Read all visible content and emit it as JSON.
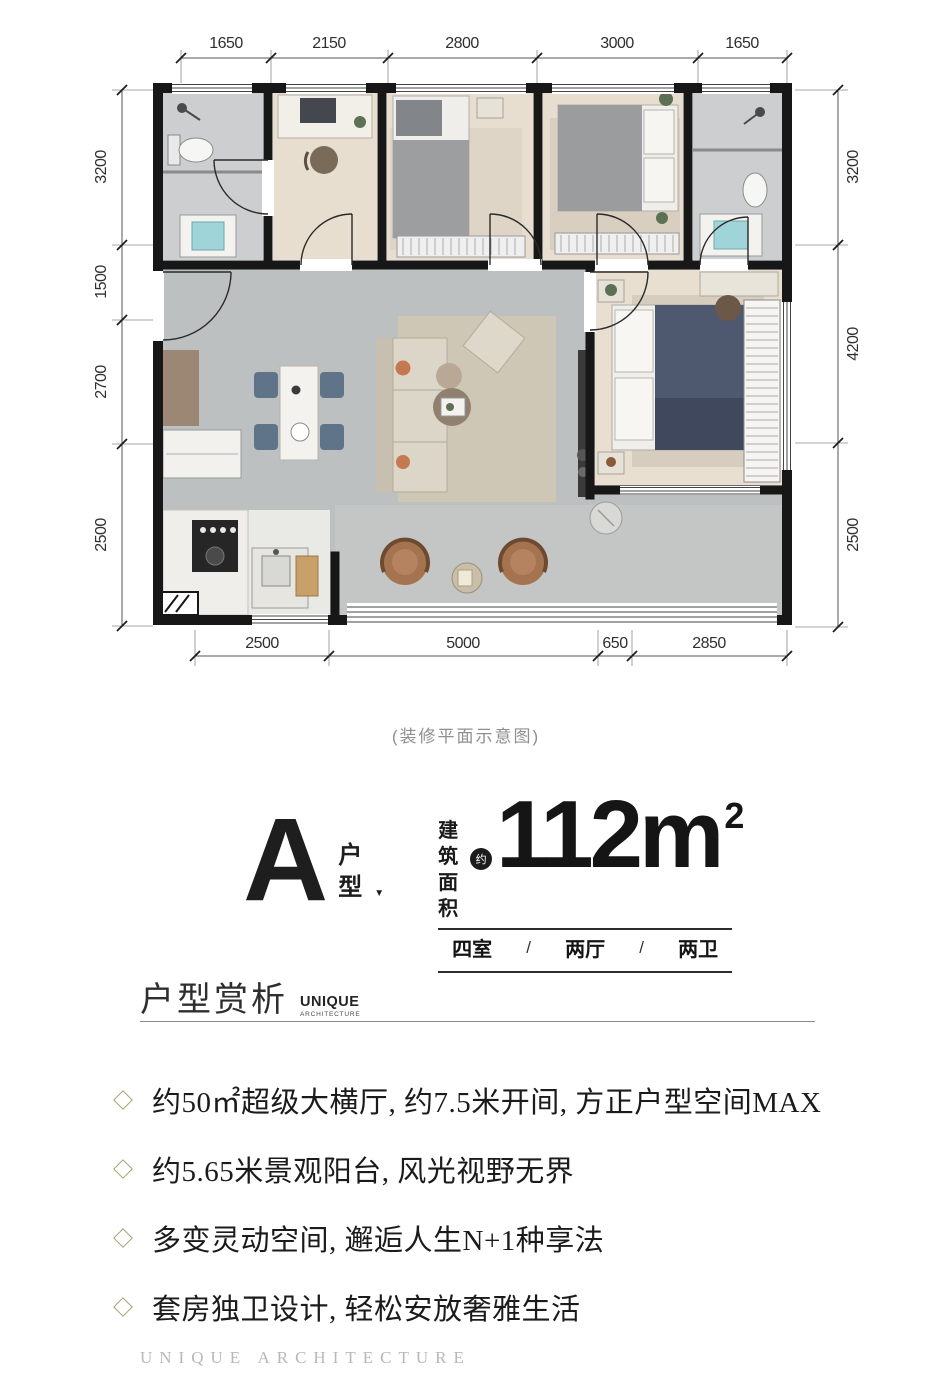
{
  "plan": {
    "caption": "(装修平面示意图)",
    "dims_top": [
      "1650",
      "2150",
      "2800",
      "3000",
      "1650"
    ],
    "dims_left": [
      "3200",
      "1500",
      "2700",
      "2500"
    ],
    "dims_right": [
      "3200",
      "4200",
      "2500"
    ],
    "dims_bottom": [
      "2500",
      "5000",
      "650",
      "2850"
    ]
  },
  "unit": {
    "letter": "A",
    "type_char_1": "户",
    "type_char_2": "型",
    "pointer": "▼",
    "area_label_1": "建筑",
    "area_label_2": "面积",
    "approx_badge": "约",
    "area_value": "112m",
    "area_exponent": "2",
    "layout_rooms": "四室",
    "layout_sep_1": "/",
    "layout_halls": "两厅",
    "layout_sep_2": "/",
    "layout_baths": "两卫"
  },
  "section": {
    "title": "户型赏析",
    "brand_name": "UNIQUE",
    "brand_sub": "ARCHITECTURE"
  },
  "features": [
    {
      "text": "约50㎡超级大横厅, 约7.5米开间, 方正户型空间MAX"
    },
    {
      "text": "约5.65米景观阳台, 风光视野无界"
    },
    {
      "text": "多变灵动空间, 邂逅人生N+1种享法"
    },
    {
      "text": "套房独卫设计, 轻松安放奢雅生活"
    }
  ],
  "footer": {
    "brand": "UNIQUE ARCHITECTURE"
  },
  "colors": {
    "wall": "#171717",
    "floor_living": "#bdc0c1",
    "floor_wood": "#e8decf",
    "floor_bath": "#ccced0",
    "accent_bullet": "#a89f70",
    "bed_navy": "#4e586e",
    "chair_blue": "#5f7488",
    "chair_brown": "#a4734f",
    "text_muted": "#8f8f8f"
  }
}
